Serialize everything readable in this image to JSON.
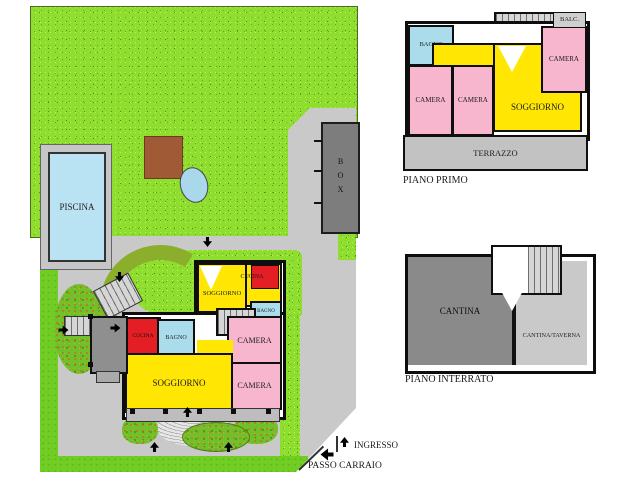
{
  "colors": {
    "room_yellow": "#ffe603",
    "room_pink": "#f7b6cd",
    "room_blue": "#aadcec",
    "room_red": "#e31e24",
    "grass_green": "#8fdd2f",
    "paving_gray": "#c9c9c9",
    "structure_dark_gray": "#7d7d7d",
    "cantina_dark": "#8a8a8a",
    "cantina_light": "#c9c9c9",
    "shed_brown": "#a05a35",
    "water_blue": "#b9e2f2",
    "wall_black": "#0d0d0d"
  },
  "site_plan": {
    "pool_label": "PISCINA",
    "garage_label": "BOX",
    "entrance_label": "INGRESSO",
    "driveway_label": "PASSO CARRAIO",
    "ground_floor": {
      "soggiorno_upper": "SOGGIORNO",
      "cucina_upper": "CUCINA",
      "bagno_upper": "BAGNO",
      "camera_1": "CAMERA",
      "camera_2": "CAMERA",
      "cucina_lower": "CUCINA",
      "bagno_lower": "BAGNO",
      "soggiorno_main": "SOGGIORNO"
    }
  },
  "piano_primo": {
    "title": "PIANO PRIMO",
    "rooms": {
      "bagno": "BAGNO",
      "balcone": "BALC.",
      "camera_left": "CAMERA",
      "camera_center": "CAMERA",
      "camera_right": "CAMERA",
      "soggiorno": "SOGGIORNO",
      "terrazzo": "TERRAZZO"
    }
  },
  "piano_interrato": {
    "title": "PIANO INTERRATO",
    "rooms": {
      "cantina": "CANTINA",
      "cantina_taverna": "CANTINA/TAVERNA"
    }
  }
}
